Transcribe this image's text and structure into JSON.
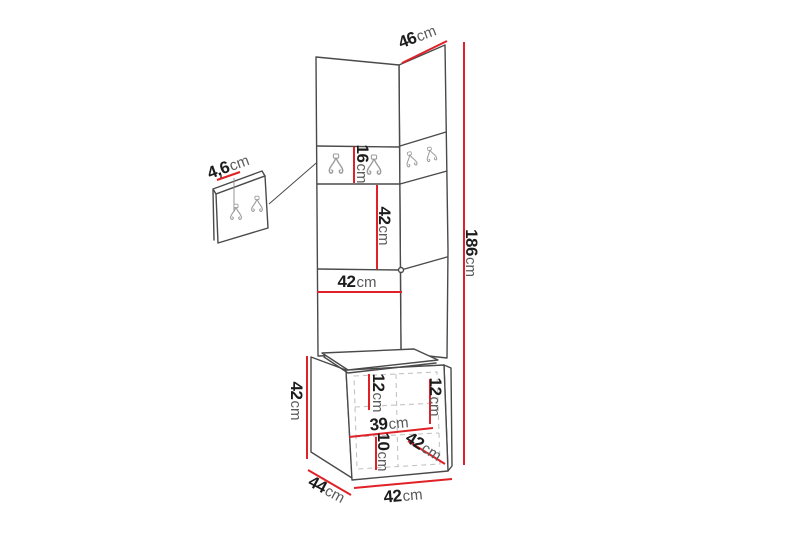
{
  "colors": {
    "dimension_red": "#e02128",
    "outline_gray": "#4a4a4a",
    "hook_gray": "#9b9b9b",
    "dashed_gray": "#c3c3c3",
    "digit_black": "#1c1c1c",
    "unit_gray": "#5a5a5a"
  },
  "dimensions": {
    "side_top_width": {
      "value": "46",
      "unit": "cm"
    },
    "total_height": {
      "value": "186",
      "unit": "cm"
    },
    "hook_panel_height": {
      "value": "16",
      "unit": "cm"
    },
    "middle_panel_height": {
      "value": "42",
      "unit": "cm"
    },
    "front_panel_width": {
      "value": "42",
      "unit": "cm"
    },
    "small_panel_thickness": {
      "value": "4,6",
      "unit": "cm"
    },
    "bench_height": {
      "value": "42",
      "unit": "cm"
    },
    "inner_left_height": {
      "value": "12",
      "unit": "cm"
    },
    "inner_right_height": {
      "value": "12",
      "unit": "cm"
    },
    "inner_width": {
      "value": "39",
      "unit": "cm"
    },
    "plinth_height": {
      "value": "10",
      "unit": "cm"
    },
    "bench_depth": {
      "value": "42",
      "unit": "cm"
    },
    "bench_side_width": {
      "value": "44",
      "unit": "cm"
    },
    "bench_front_width": {
      "value": "42",
      "unit": "cm"
    }
  }
}
